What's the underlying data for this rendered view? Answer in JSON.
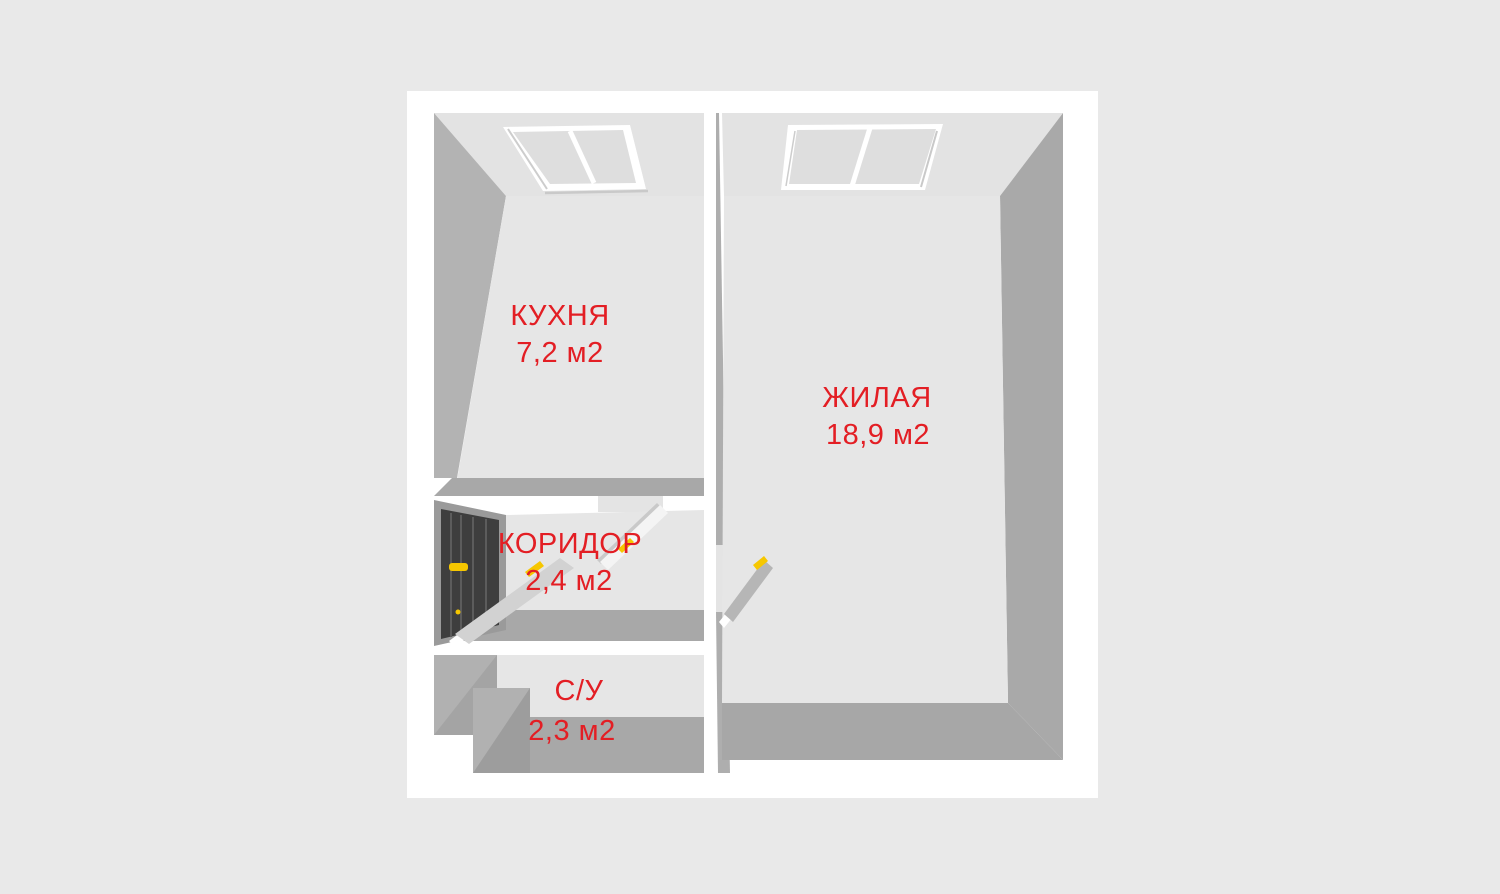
{
  "plan": {
    "title": "apartment-floor-plan-3d",
    "rooms": [
      {
        "id": "kitchen",
        "label": "КУХНЯ",
        "area": "7,2 м2"
      },
      {
        "id": "living",
        "label": "ЖИЛАЯ",
        "area": "18,9 м2"
      },
      {
        "id": "corridor",
        "label": "КОРИДОР",
        "area": "2,4 м2"
      },
      {
        "id": "bathroom",
        "label": "С/У",
        "area": "2,3 м2"
      }
    ],
    "features": {
      "windows": [
        "kitchen-window",
        "living-room-window"
      ],
      "doors": [
        "entrance-door",
        "bathroom-door-leaf",
        "kitchen-door-leaf",
        "living-room-door-leaf"
      ]
    },
    "colors": {
      "background": "#e9e9e9",
      "wall_top": "#ffffff",
      "wall_face_light": "#e3e3e3",
      "wall_face_dark": "#a9a9a9",
      "floor": "#e6e6e6",
      "label_red": "#e31e24",
      "entrance_door": "#3e3e3e",
      "handle_yellow": "#f6c700"
    }
  }
}
